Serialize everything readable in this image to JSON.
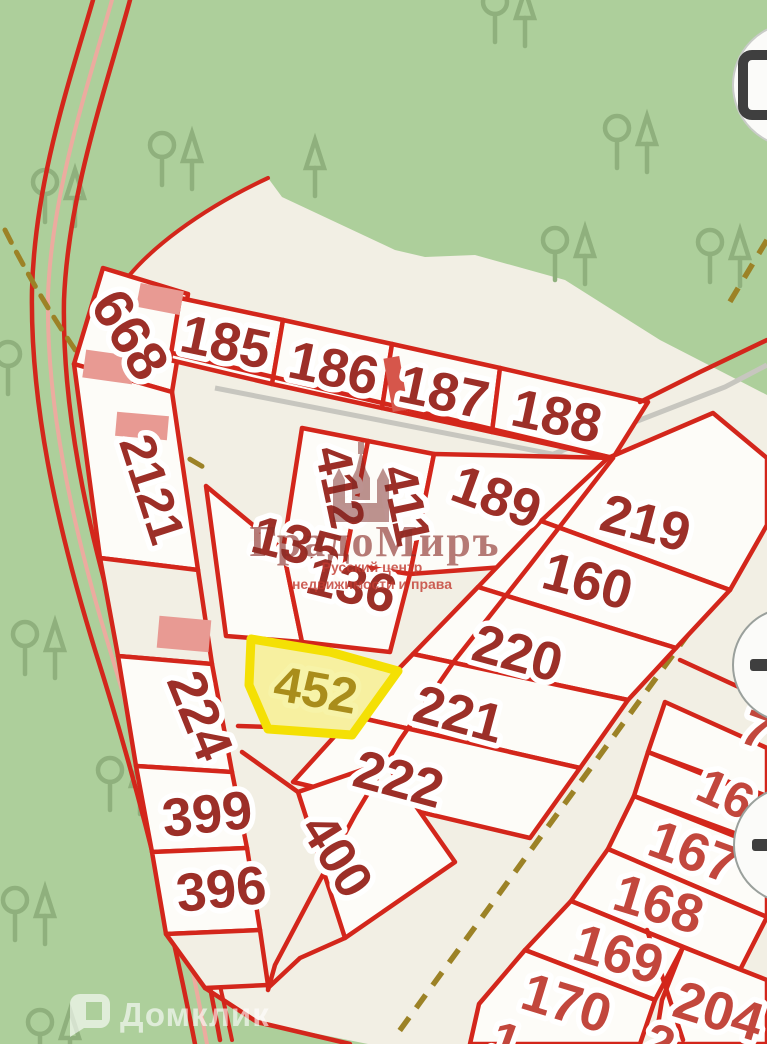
{
  "map": {
    "colors": {
      "forest_green": "#adcf9b",
      "land_beige": "#f2efe4",
      "boundary_red": "#d3261b",
      "label_dark_red": "#9c2f28",
      "label_bright_red": "#c2473d",
      "road_pink": "#ecab9f",
      "path_olive": "#9c8226",
      "road_gray": "#c7c6bf",
      "highlight_fill": "#f7f0a0",
      "highlight_border": "#f4e004",
      "highlight_text": "#a98d1b"
    },
    "highlighted_plot": "452",
    "plots": [
      {
        "num": "668",
        "x": 131,
        "y": 334,
        "rot": 58,
        "tone": "dark",
        "s": 56
      },
      {
        "num": "185",
        "x": 226,
        "y": 341,
        "rot": 12,
        "tone": "dark"
      },
      {
        "num": "186",
        "x": 334,
        "y": 367,
        "rot": 12,
        "tone": "dark"
      },
      {
        "num": "187",
        "x": 444,
        "y": 391,
        "rot": 12,
        "tone": "dark"
      },
      {
        "num": "188",
        "x": 557,
        "y": 415,
        "rot": 12,
        "tone": "dark"
      },
      {
        "num": "2121",
        "x": 153,
        "y": 489,
        "rot": 72,
        "tone": "dark",
        "s": 50
      },
      {
        "num": "412",
        "x": 341,
        "y": 487,
        "rot": 78,
        "tone": "dark",
        "s": 50
      },
      {
        "num": "411",
        "x": 407,
        "y": 505,
        "rot": 78,
        "tone": "dark",
        "s": 50
      },
      {
        "num": "189",
        "x": 497,
        "y": 496,
        "rot": 20,
        "tone": "dark"
      },
      {
        "num": "219",
        "x": 646,
        "y": 522,
        "rot": 15,
        "tone": "dark"
      },
      {
        "num": "135",
        "x": 297,
        "y": 543,
        "rot": 14,
        "tone": "dark"
      },
      {
        "num": "136",
        "x": 352,
        "y": 584,
        "rot": 14,
        "tone": "dark"
      },
      {
        "num": "160",
        "x": 588,
        "y": 580,
        "rot": 15,
        "tone": "dark"
      },
      {
        "num": "220",
        "x": 518,
        "y": 652,
        "rot": 15,
        "tone": "dark"
      },
      {
        "num": "452",
        "x": 316,
        "y": 689,
        "rot": 10,
        "tone": "gold",
        "s": 50
      },
      {
        "num": "221",
        "x": 459,
        "y": 713,
        "rot": 15,
        "tone": "dark"
      },
      {
        "num": "224",
        "x": 201,
        "y": 715,
        "rot": 68,
        "tone": "dark"
      },
      {
        "num": "222",
        "x": 399,
        "y": 778,
        "rot": 15,
        "tone": "dark"
      },
      {
        "num": "399",
        "x": 207,
        "y": 813,
        "rot": -6,
        "tone": "dark"
      },
      {
        "num": "400",
        "x": 338,
        "y": 855,
        "rot": 58,
        "tone": "dark",
        "s": 52
      },
      {
        "num": "396",
        "x": 221,
        "y": 888,
        "rot": -6,
        "tone": "dark"
      },
      {
        "num": "7",
        "x": 757,
        "y": 729,
        "rot": 20,
        "tone": "bright",
        "s": 50
      },
      {
        "num": "16",
        "x": 726,
        "y": 793,
        "rot": 24,
        "tone": "bright",
        "s": 50
      },
      {
        "num": "167",
        "x": 694,
        "y": 851,
        "rot": 20,
        "tone": "bright"
      },
      {
        "num": "168",
        "x": 659,
        "y": 903,
        "rot": 17,
        "tone": "bright"
      },
      {
        "num": "169",
        "x": 619,
        "y": 953,
        "rot": 17,
        "tone": "bright"
      },
      {
        "num": "170",
        "x": 567,
        "y": 1002,
        "rot": 17,
        "tone": "bright"
      },
      {
        "num": "204",
        "x": 719,
        "y": 1010,
        "rot": 17,
        "tone": "bright"
      },
      {
        "num": "1",
        "x": 506,
        "y": 1040,
        "rot": 20,
        "tone": "bright",
        "s": 50
      },
      {
        "num": "2",
        "x": 660,
        "y": 1042,
        "rot": 20,
        "tone": "bright",
        "s": 50
      }
    ],
    "watermark": {
      "brand": "ГрадоМиръ",
      "sub_line1": "Русский центр",
      "sub_line2": "недвижимости и права"
    },
    "provider": {
      "name": "Домклик"
    },
    "controls": [
      {
        "name": "layers"
      },
      {
        "name": "zoom-in"
      },
      {
        "name": "zoom-out"
      }
    ]
  }
}
